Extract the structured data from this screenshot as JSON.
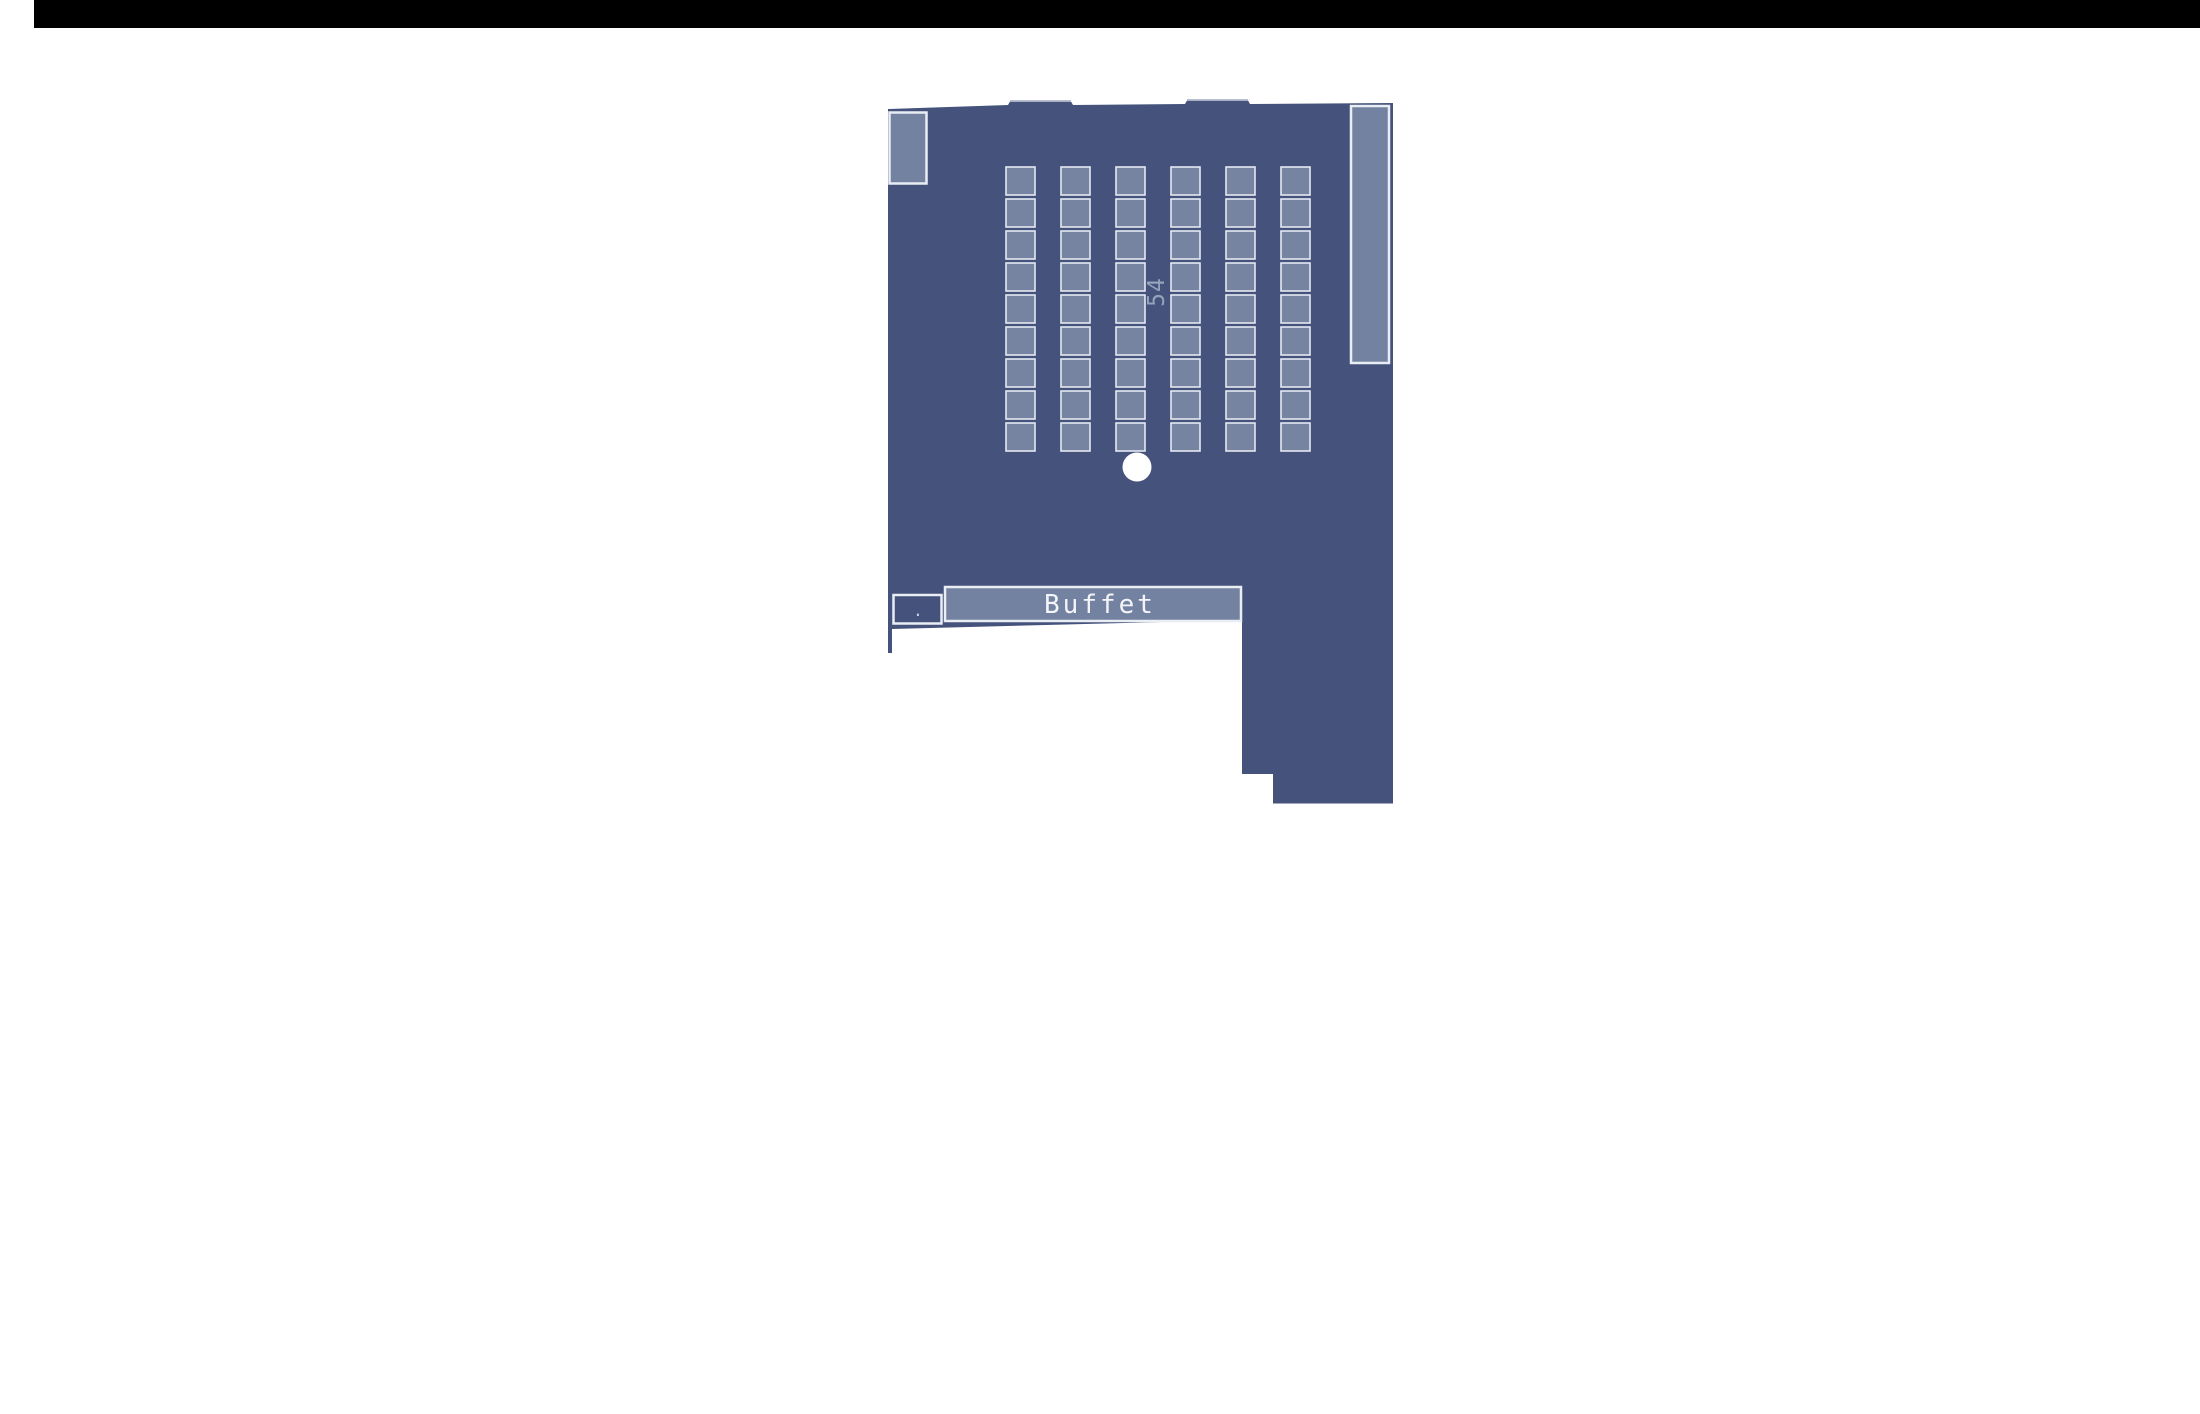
{
  "page": {
    "background": "#ffffff"
  },
  "top_bar": {
    "color": "#000000"
  },
  "floor_plan": {
    "seat_count_label": "54",
    "buffet_label": "Buffet",
    "cabinet_dot_label": ".",
    "seat_grid": {
      "columns": 6,
      "rows": 9,
      "total_seats": 54
    },
    "colors": {
      "room_fill": "#45527C",
      "seat_fill": "#7683A1",
      "seat_outline": "#E4E9F2",
      "fixture_fill": "#7482A2",
      "outline": "#E9EDF4",
      "label_color": "#96A2BC",
      "text_color": "#F3F5F9",
      "dot_color": "#C9D1DF",
      "marker_fill": "#ffffff",
      "bump_cap": "#A9B3C8"
    }
  }
}
